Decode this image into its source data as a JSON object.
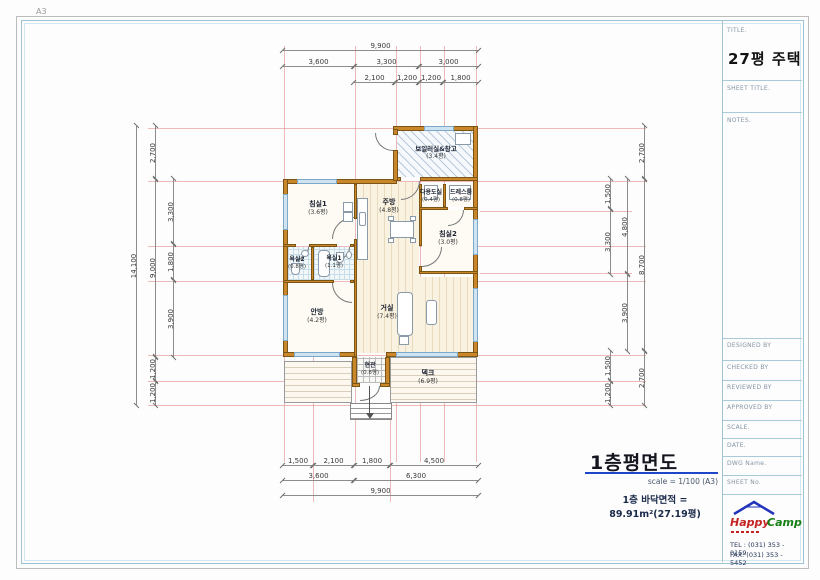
{
  "page": {
    "size_label": "A3"
  },
  "title_block": {
    "title_label": "TITLE.",
    "title": "27평 주택",
    "sheet_title_label": "SHEET TITLE.",
    "notes_label": "NOTES.",
    "fields": [
      "DESIGNED BY",
      "CHECKED BY",
      "REVIEWED BY",
      "APPROVED BY",
      "SCALE.",
      "DATE.",
      "DWG Name.",
      "SHEET No."
    ],
    "logo": {
      "word1": "Happy",
      "word2": "Camp",
      "tel": "TEL : (031) 353 - 0159",
      "fax": "FAX: (031) 353 - 5452"
    }
  },
  "drawing": {
    "caption": {
      "title": "1층평면도",
      "scale": "scale = 1/100 (A3)",
      "area": "1층 바닥면적 = 89.91m²(27.19평)"
    },
    "rooms": [
      {
        "name": "보일러실&창고",
        "area": "(3.4평)"
      },
      {
        "name": "침실1",
        "area": "(3.6평)"
      },
      {
        "name": "주방",
        "area": "(4.8평)"
      },
      {
        "name": "다용도실",
        "area": "(0.4평)"
      },
      {
        "name": "드레스룸",
        "area": "(0.8평)"
      },
      {
        "name": "침실2",
        "area": "(3.0평)"
      },
      {
        "name": "욕실2",
        "area": "(0.8평)"
      },
      {
        "name": "욕실1",
        "area": "(1.1평)"
      },
      {
        "name": "안방",
        "area": "(4.2평)"
      },
      {
        "name": "거실",
        "area": "(7.4평)"
      },
      {
        "name": "현관",
        "area": "(0.8평)"
      },
      {
        "name": "덱크",
        "area": "(6.9평)"
      }
    ],
    "dims": {
      "top": {
        "row1": [
          "9,900"
        ],
        "row2": [
          "3,600",
          "3,300",
          "3,000"
        ],
        "row3": [
          "2,100",
          "1,200",
          "1,200",
          "1,800"
        ]
      },
      "bottom": {
        "row1": [
          "1,500",
          "2,100",
          "1,800",
          "4,500"
        ],
        "row2": [
          "3,600",
          "6,300"
        ],
        "row3": [
          "9,900"
        ]
      },
      "left": {
        "outer": [
          "14,100"
        ],
        "mid": [
          "2,700",
          "9,000",
          "1,200",
          "1,200"
        ],
        "inner": [
          "3,300",
          "1,800",
          "3,900"
        ]
      },
      "right": {
        "outer": [
          "2,700",
          "8,700",
          "2,700"
        ],
        "mid": [
          "4,800",
          "3,900"
        ],
        "inner": [
          "1,500",
          "3,300",
          "1,500",
          "1,200"
        ]
      }
    },
    "colors": {
      "wall": "#c9862b",
      "grid_line": "#e07676",
      "caption_underline": "#1e46c8",
      "logo_happy": "#c52222",
      "logo_camp": "#168016",
      "logo_roof": "#2233bb"
    }
  }
}
